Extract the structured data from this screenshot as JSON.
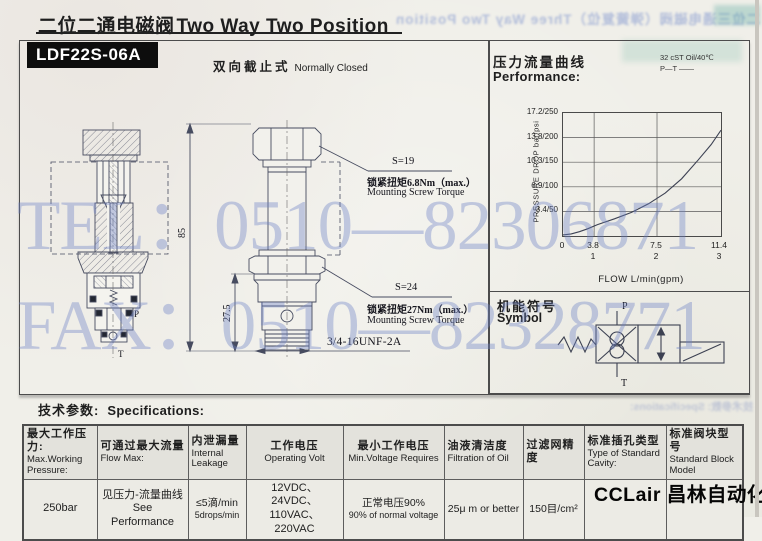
{
  "header": {
    "title_zh": "二位二通电磁阀",
    "title_en": "Two Way Two Position"
  },
  "model_badge": "LDF22S-06A",
  "variant": {
    "zh": "双向截止式",
    "en": "Normally Closed"
  },
  "bleed": {
    "top": "二位三通电磁阀（弹簧复位）Three Way Two Position",
    "bottom": "技术参数: Specifications:"
  },
  "performance": {
    "title_zh": "压力流量曲线",
    "title_en": "Performance:",
    "oil_note": "32 cST Oil/40℃",
    "curve_note": "P—T ——"
  },
  "chart_data": {
    "type": "line",
    "title": "压力流量曲线 Performance",
    "xlabel": "FLOW L/min(gpm)",
    "ylabel": "PRESSURE DROP bar/psi",
    "xlim": [
      0,
      11.4
    ],
    "ylim": [
      0,
      17.2
    ],
    "grid": true,
    "legend_position": "none",
    "x_ticks": [
      {
        "top": "0",
        "bottom": ""
      },
      {
        "top": "3.8",
        "bottom": "1"
      },
      {
        "top": "7.5",
        "bottom": "2"
      },
      {
        "top": "11.4",
        "bottom": "3"
      }
    ],
    "y_ticks": [
      "17.2/250",
      "13.8/200",
      "10.3/150",
      "6.9/100",
      "3.4/50"
    ],
    "series": [
      {
        "name": "P—T",
        "x": [
          0,
          1,
          2,
          3,
          4,
          5,
          6,
          7,
          8,
          9,
          10,
          10.8,
          11.4
        ],
        "y": [
          0.15,
          0.3,
          0.6,
          1.0,
          1.6,
          2.4,
          3.3,
          4.5,
          6.0,
          8.0,
          10.6,
          12.8,
          14.8
        ]
      }
    ]
  },
  "drawing": {
    "dim_height": "85",
    "dim_cartridge": "27.5",
    "port_p": "P",
    "port_t": "T",
    "thread": "3/4-16UNF-2A",
    "ann_top": {
      "s": "S=19",
      "torque_zh": "锁紧扭矩6.8Nm（max.）",
      "torque_en": "Mounting Screw Torque"
    },
    "ann_mid": {
      "s": "S=24",
      "torque_zh": "锁紧扭矩27Nm（max.）",
      "torque_en": "Mounting Screw Torque"
    }
  },
  "symbol": {
    "title_zh": "机能符号",
    "title_en": "Symbol",
    "port_top": "P",
    "port_bottom": "T"
  },
  "specs": {
    "title_zh": "技术参数:",
    "title_en": "Specifications:",
    "columns": [
      {
        "zh": "最大工作压力:",
        "en": "Max.Working Pressure:"
      },
      {
        "zh": "可通过最大流量",
        "en": "Flow Max:"
      },
      {
        "zh": "内泄漏量",
        "en": "Internal Leakage"
      },
      {
        "zh": "工作电压",
        "en": "Operating Volt"
      },
      {
        "zh": "最小工作电压",
        "en": "Min.Voltage Requires"
      },
      {
        "zh": "油液清洁度",
        "en": "Filtration of Oil"
      },
      {
        "zh": "过滤网精度",
        "en": ""
      },
      {
        "zh": "标准插孔类型",
        "en": "Type of Standard Cavity:"
      },
      {
        "zh": "标准阀块型号",
        "en": "Standard Block Model"
      }
    ],
    "row": {
      "pressure": "250bar",
      "flow_zh": "见压力-流量曲线",
      "flow_en": "See Performance",
      "leak_zh": "≤5滴/min",
      "leak_en": "5drops/min",
      "volt_line1": "12VDC、24VDC、",
      "volt_line2": "110VAC、220VAC",
      "minvolt_zh": "正常电压90%",
      "minvolt_en": "90% of normal voltage",
      "filtration": "25μ m or better",
      "mesh": "150目/cm²"
    }
  },
  "logo": "CCLair 昌林自动化",
  "watermark": {
    "line1": "TEL：0510—82306871",
    "line2": "FAX：0510—82328771"
  },
  "colors": {
    "ink": "#1e1e1e",
    "line_art": "#474c60",
    "watermark_blue": "#6c80c6",
    "badge_bg": "#0d0d0d"
  }
}
